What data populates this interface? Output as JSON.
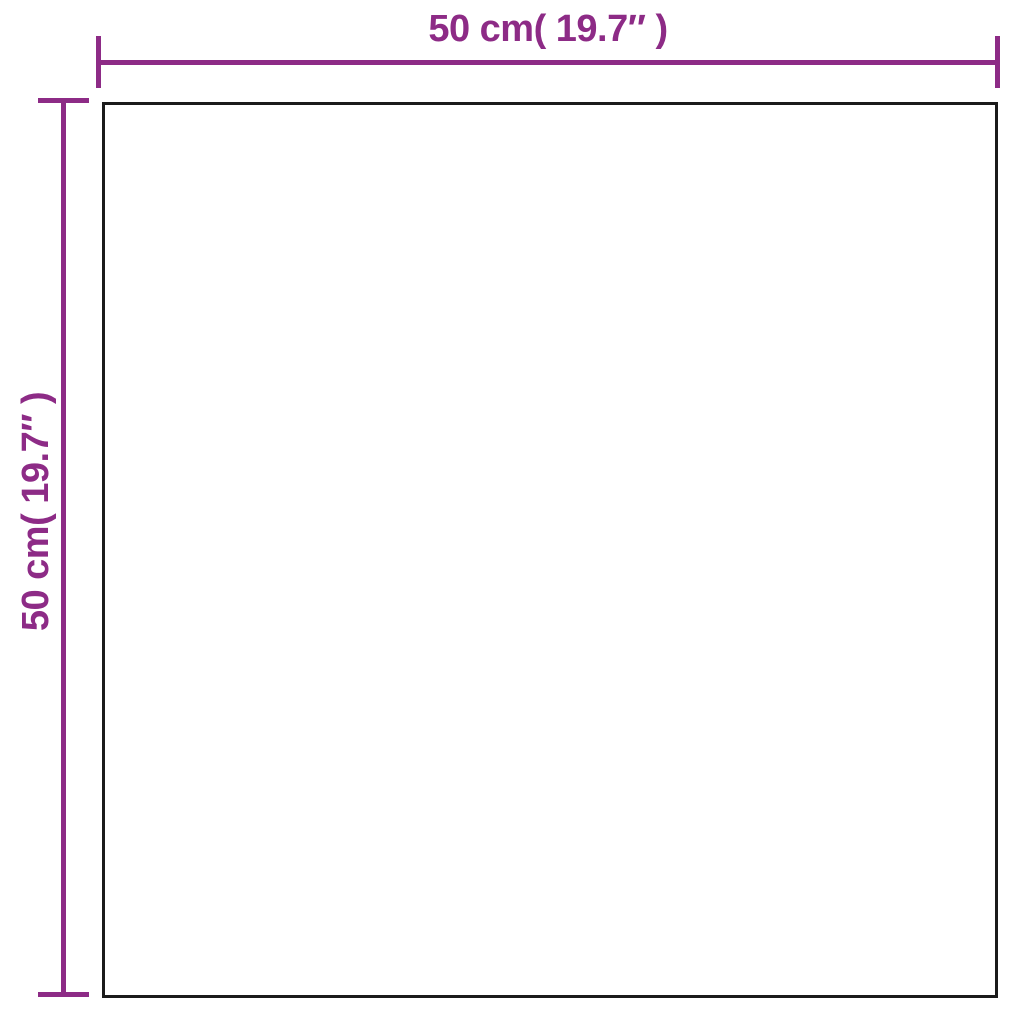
{
  "colors": {
    "accent": "#8D2B86",
    "outline": "#1B1B1B",
    "background": "#FFFFFF"
  },
  "diagram": {
    "type": "product-dimension-diagram",
    "shape": "square",
    "width": {
      "label": "50 cm( 19.7″ )",
      "cm": 50,
      "inches": 19.7
    },
    "height": {
      "label": "50 cm( 19.7″ )",
      "cm": 50,
      "inches": 19.7
    }
  }
}
